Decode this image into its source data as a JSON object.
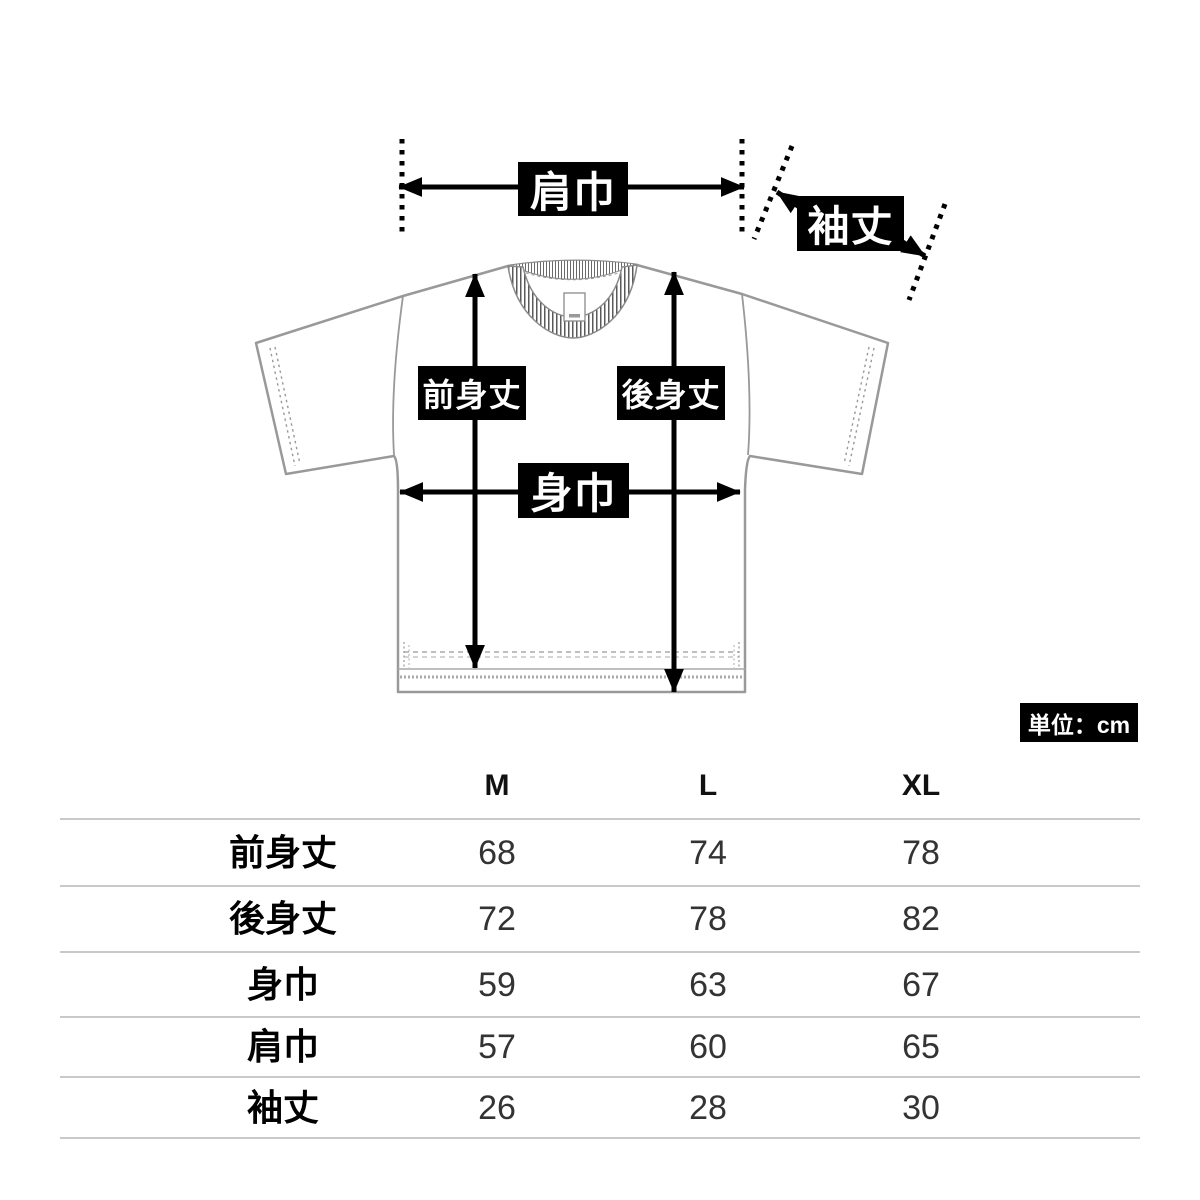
{
  "diagram": {
    "shoulder_width_label": "肩巾",
    "sleeve_length_label": "袖丈",
    "front_length_label": "前身丈",
    "back_length_label": "後身丈",
    "body_width_label": "身巾",
    "unit_badge": "単位：cm"
  },
  "size_table": {
    "columns": [
      "M",
      "L",
      "XL"
    ],
    "rows": [
      {
        "label": "前身丈",
        "values": [
          68,
          74,
          78
        ]
      },
      {
        "label": "後身丈",
        "values": [
          72,
          78,
          82
        ]
      },
      {
        "label": "身巾",
        "values": [
          59,
          63,
          67
        ]
      },
      {
        "label": "肩巾",
        "values": [
          57,
          60,
          65
        ]
      },
      {
        "label": "袖丈",
        "values": [
          26,
          28,
          30
        ]
      }
    ]
  },
  "chart_data": {
    "type": "table",
    "categories": [
      "M",
      "L",
      "XL"
    ],
    "series": [
      {
        "name": "前身丈",
        "values": [
          68,
          74,
          78
        ]
      },
      {
        "name": "後身丈",
        "values": [
          72,
          78,
          82
        ]
      },
      {
        "name": "身巾",
        "values": [
          59,
          63,
          67
        ]
      },
      {
        "name": "肩巾",
        "values": [
          57,
          60,
          65
        ]
      },
      {
        "name": "袖丈",
        "values": [
          26,
          28,
          30
        ]
      }
    ],
    "unit": "cm"
  },
  "colors": {
    "arrow": "#000000",
    "label_bg": "#000000",
    "label_text": "#ffffff",
    "garment_outline": "#999999",
    "table_divider": "#c9c9c9"
  }
}
